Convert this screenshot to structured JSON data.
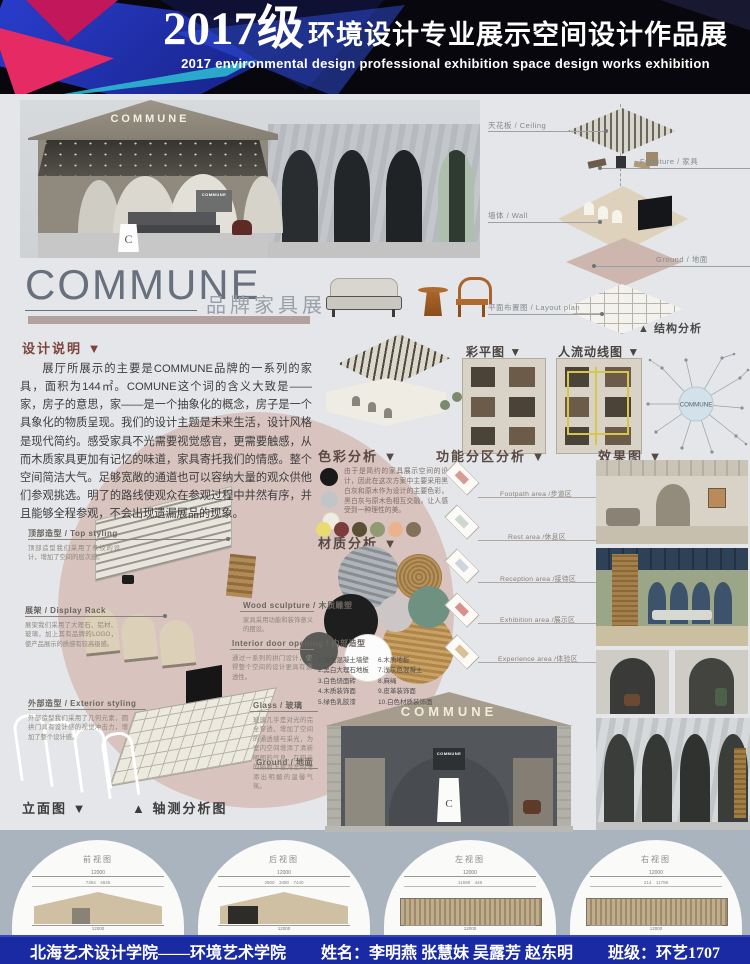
{
  "header": {
    "year": "2017级",
    "title_cn": "环境设计专业展示空间设计作品展",
    "title_en": "2017 environmental design professional exhibition space design works exhibition"
  },
  "hero": {
    "sign": "COMMUNE",
    "inner_sign": "COMMUNE",
    "logo_letter": "C"
  },
  "brand": {
    "name": "COMMUNE",
    "subtitle": "品牌家具展"
  },
  "structure": {
    "caption": "▲ 结构分析",
    "labels": {
      "ceiling": "天花板 / Ceiling",
      "furniture": "Furniture / 家具",
      "wall": "墙体 / Wall",
      "ground": "Ground / 地面",
      "layout": "平面布置图 / Layout plan"
    }
  },
  "design_note": {
    "heading": "设计说明 ▼",
    "body": "展厅所展示的主要是COMMUNE品牌的一系列的家具，面积为144㎡。COMUNE这个词的含义大致是——家，房子的意思，家——是一个抽象化的概念，房子是一个具象化的物质呈现。我们的设计主题是未来生活，设计风格是现代简约。感受家具不光需要视觉感官，更需要触感，从而木质家具更加有记忆的味道，家具寄托我们的情感。整个空间简洁大气。足够宽敞的通道也可以容纳大量的观众供他们参观挑选。明了的路线使观众在参观过程中井然有序，并且能够全程参观，不会出现遗漏展品的现象。"
  },
  "plans": {
    "color_plan": "彩平图 ▼",
    "flow_plan": "人流动线图 ▼",
    "mindmap_center": "COMMUNE"
  },
  "color_analysis": {
    "heading": "色彩分析 ▼",
    "note": "由于是简约的家具展示空间的设计，因此在这次方案中主要采用黑白灰和原木作为设计的主要色彩，黑白灰与原木色相互交融，让人感受到一种理性的美。",
    "main_colors": [
      "#191919",
      "#c2c5c7",
      "#f0ecdf"
    ],
    "accent_colors": [
      "#e9da72",
      "#7b3c3c",
      "#585134",
      "#8f9b6e",
      "#eab38e",
      "#83715a"
    ]
  },
  "function_zones": {
    "heading": "功能分区分析 ▼",
    "zones": [
      {
        "label": "Footpath area /步道区",
        "color": "#d99a94"
      },
      {
        "label": "Rest area /休息区",
        "color": "#cfd8cf"
      },
      {
        "label": "Reception area /接待区",
        "color": "#cdd5dd"
      },
      {
        "label": "Exhibition area /展示区",
        "color": "#d98f8c"
      },
      {
        "label": "Experience area /体验区",
        "color": "#d9c196"
      }
    ]
  },
  "renders": {
    "heading": "效果图 ▼"
  },
  "materials": {
    "heading": "材质分析 ▼",
    "left": [
      "1.浅色混凝土墙壁",
      "2.黑白大理石地板",
      "3.白色烧面砖",
      "4.木质装饰面",
      "5.绿色乳胶漆"
    ],
    "right": [
      "6.木质地板",
      "7.浅灰色混凝土",
      "8.麻绳",
      "9.皮革装饰面",
      "10.白色材质装饰面"
    ]
  },
  "axon_detail": {
    "top_styling": {
      "title": "顶部造型 / Top styling",
      "caption": "顶部造型我们采用了条纹的设计，增加了空间的层次感。"
    },
    "display_rack": {
      "title": "展架 / Display Rack",
      "caption": "展架我们采用了大理石、铝材、玻璃，加上其有品牌的LOGO，使产品展示的质感有较高级感。"
    },
    "exterior": {
      "title": "外部造型 / Exterior styling",
      "caption": "外部造型我们采用了几何元素，圆拱门具有设计感的视觉冲击力，增加了整个设计感。"
    },
    "wood_sculpture": {
      "title": "Wood sculpture / 木质雕塑",
      "caption": "家具采用功能和装饰意义的摆设。"
    },
    "interior_door": {
      "title": "Interior door opening / 内部造型",
      "caption": "通过一系列的拱门设计，使得整个空间的设计更具有通透性。"
    },
    "glass": {
      "title": "Glass / 玻璃",
      "caption": "玻璃几乎是对光的完全穿透，增加了空间的通透感与采光，为室内空间增添了清新明朗的气息，在阳光的照射下更为室内增添出明媚的温馨气氛。"
    },
    "ground": {
      "title": "Ground / 地面"
    }
  },
  "bottom_labels": {
    "elevation": "立面图 ▼",
    "axon": "▲ 轴测分析图"
  },
  "elevations": [
    {
      "title": "前视图",
      "dim_total": "12000",
      "dims": "7354　4645",
      "dim_bottom": "12000"
    },
    {
      "title": "后视图",
      "dim_total": "12000",
      "dims": "2900　3490　7440",
      "dim_bottom": "12000"
    },
    {
      "title": "左视图",
      "dim_total": "12000",
      "dims": "11598　446",
      "dim_bottom": "12000"
    },
    {
      "title": "右视图",
      "dim_total": "12000",
      "dims": "214　11786",
      "dim_bottom": "12000"
    }
  ],
  "footer": {
    "school": "北海艺术设计学院——环境艺术学院",
    "name_label": "姓名：",
    "names": "李明燕 张慧妹 吴露芳 赵东明",
    "class_label": "班级：",
    "class_value": "环艺1707"
  }
}
